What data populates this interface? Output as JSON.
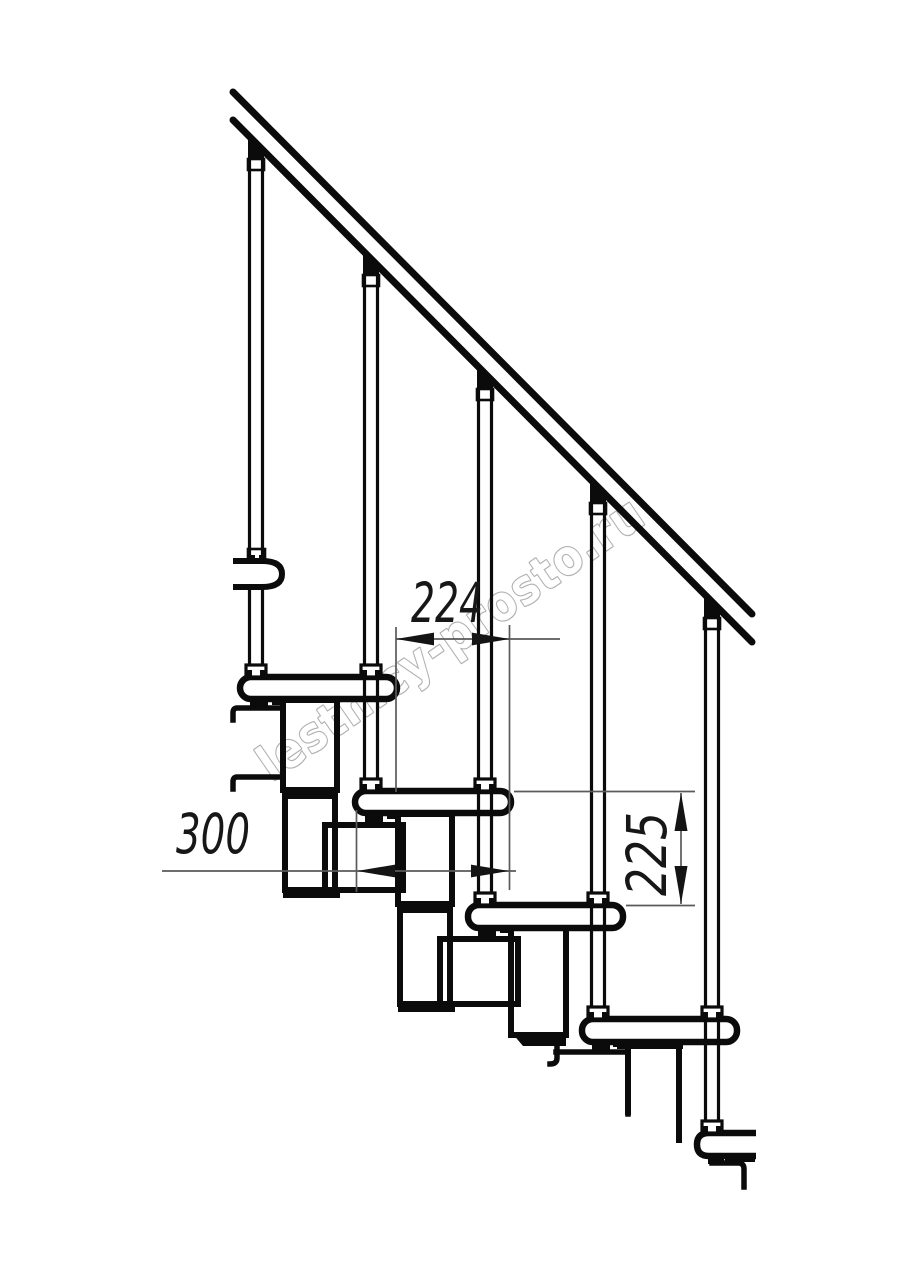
{
  "page": {
    "width": 914,
    "height": 1280,
    "background": "#ffffff"
  },
  "drawing": {
    "title": "Modular staircase side elevation (fragment)",
    "style": "black-and-white technical line drawing",
    "colors": {
      "outline": "#0b0b0b",
      "dimension_line": "#5a5a5a",
      "dimension_text": "#171717",
      "watermark_stroke": "#a4a4a4",
      "background": "#ffffff"
    },
    "structure": {
      "handrail": "inclined handrail drawn as two parallel lines",
      "baluster_count": 5,
      "tread_count": 5,
      "stringer": "chain of rectangular modules under each tread"
    },
    "dimensions": {
      "run": {
        "value": "224",
        "orientation": "horizontal"
      },
      "depth": {
        "value": "300",
        "orientation": "horizontal"
      },
      "rise": {
        "value": "225",
        "orientation": "vertical"
      }
    },
    "watermark": {
      "text": "lestnicy-prosto.ru",
      "angle_deg": -34.7
    }
  }
}
